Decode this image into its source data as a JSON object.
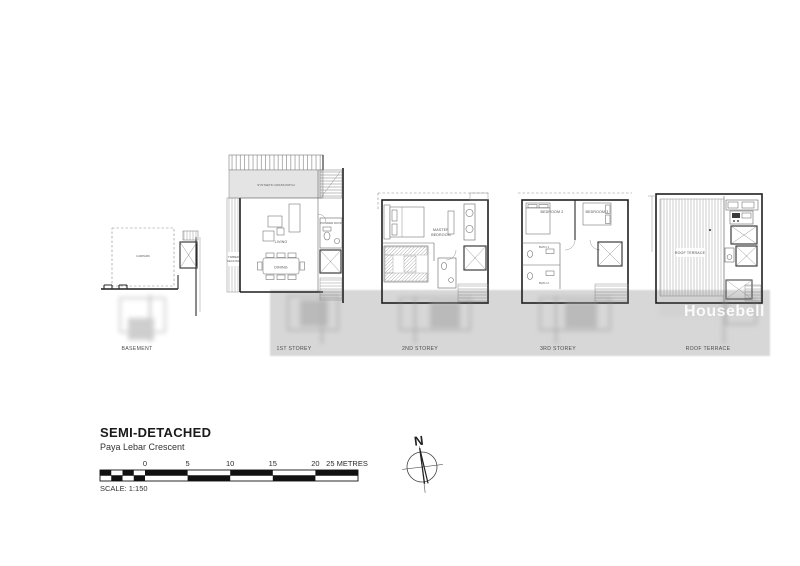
{
  "document": {
    "watermark": "Housebell"
  },
  "title_block": {
    "title": "SEMI-DETACHED",
    "subtitle": "Paya Lebar Crescent",
    "scale_note": "SCALE: 1:150",
    "ticks": [
      "0",
      "5",
      "10",
      "15",
      "20"
    ],
    "scale_end_label": "25 METRES"
  },
  "compass": {
    "north": "N"
  },
  "plans": {
    "basement": {
      "caption": "BASEMENT",
      "carpark": "CARPARK"
    },
    "first_storey": {
      "caption": "1ST STOREY",
      "grass": "SYNTHETIC GRASS PATCH",
      "living": "LIVING",
      "dining": "DINING",
      "deck_line1": "TIMBER",
      "deck_line2": "DECKING",
      "powder": "POWDER ROOM"
    },
    "second_storey": {
      "caption": "2ND STOREY",
      "master_line1": "MASTER",
      "master_line2": "BEDROOM"
    },
    "third_storey": {
      "caption": "3RD STOREY",
      "bedroom2": "BEDROOM 2",
      "bedroom3": "BEDROOM 3",
      "bath1": "BATH 1",
      "bath2": "BATH 2"
    },
    "roof": {
      "caption": "ROOF TERRACE",
      "terrace": "ROOF TERRACE"
    }
  }
}
